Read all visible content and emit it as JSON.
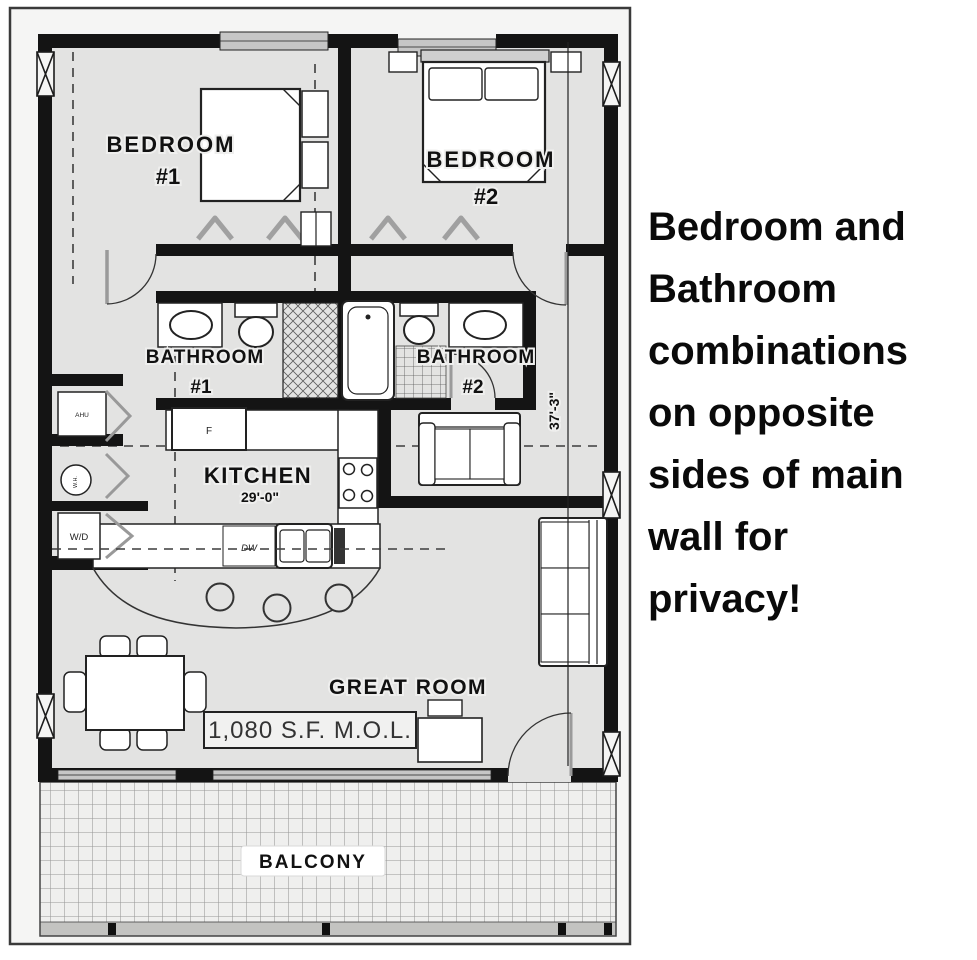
{
  "plan": {
    "bedroom1": {
      "label": "BEDROOM",
      "num": "#1"
    },
    "bedroom2": {
      "label": "BEDROOM",
      "num": "#2"
    },
    "bathroom1": {
      "label": "BATHROOM",
      "num": "#1"
    },
    "bathroom2": {
      "label": "BATHROOM",
      "num": "#2"
    },
    "kitchen": {
      "label": "KITCHEN",
      "width_dim": "29'-0\""
    },
    "great_room": {
      "label": "GREAT ROOM",
      "area": "1,080 S.F. M.O.L."
    },
    "balcony": {
      "label": "BALCONY"
    },
    "height_dim": "37'-3\"",
    "appliances": {
      "fridge": "F",
      "dishwasher": "DW",
      "washer_dryer": "W/D",
      "air_handler": "AHU",
      "water_heater": "W.H."
    }
  },
  "annotation": {
    "lines": [
      "Bedroom and",
      "Bathroom",
      "combinations",
      "on opposite",
      "sides of main",
      "wall for",
      "privacy!"
    ]
  },
  "colors": {
    "wall": "#141414",
    "paper": "#e3e3e2",
    "frame_bg": "#f5f5f4",
    "annotation_text": "#0a0a0a"
  }
}
